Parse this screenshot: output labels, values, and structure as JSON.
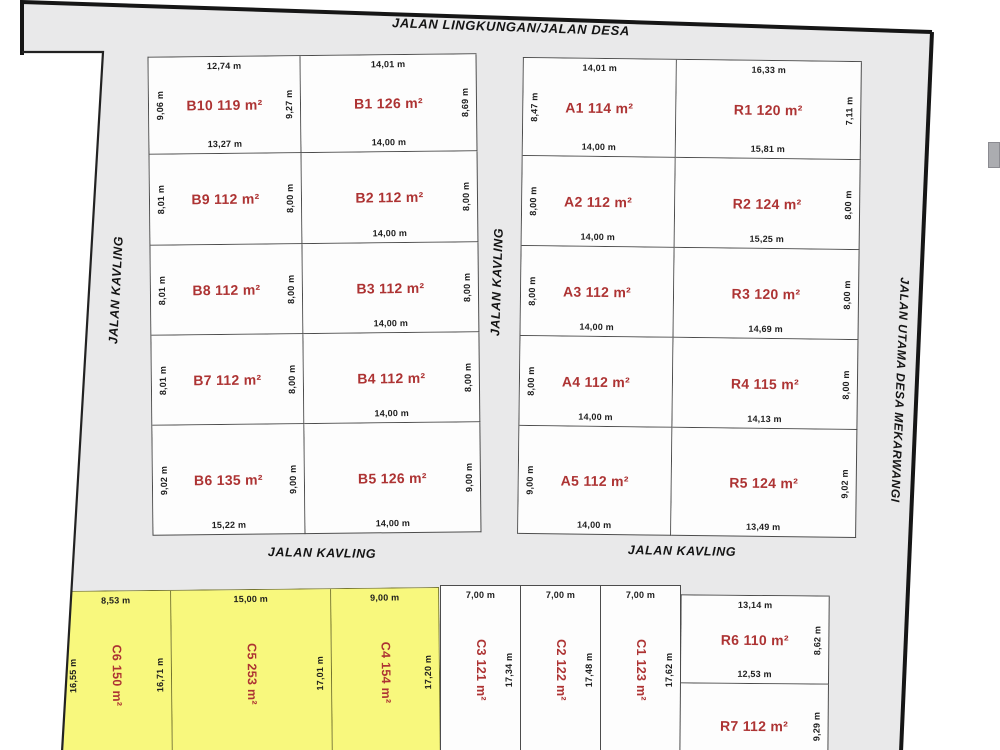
{
  "roads": {
    "top": "JALAN LINGKUNGAN/JALAN DESA",
    "left": "JALAN KAVLING",
    "middle": "JALAN KAVLING",
    "right": "JALAN UTAMA DESA MEKARWANGI",
    "bottom_left": "JALAN KAVLING",
    "bottom_right": "JALAN KAVLING"
  },
  "colors": {
    "road_fill": "#e9e9ea",
    "plot_fill": "#fdfdfd",
    "highlight_fill": "#f8f87d",
    "area_text": "#ad3333",
    "dim_text": "#1d1d1d",
    "boundary": "#161616"
  },
  "blocks": {
    "b_left": [
      {
        "id": "B10",
        "area": "B10 119 m²",
        "top": "12,74 m",
        "left": "9,06 m",
        "right": "9,27 m",
        "bottom": "13,27 m"
      },
      {
        "id": "B9",
        "area": "B9 112 m²",
        "left": "8,01 m",
        "right": "8,00 m"
      },
      {
        "id": "B8",
        "area": "B8 112 m²",
        "left": "8,01 m",
        "right": "8,00 m"
      },
      {
        "id": "B7",
        "area": "B7 112 m²",
        "left": "8,01 m",
        "right": "8,00 m"
      },
      {
        "id": "B6",
        "area": "B6 135 m²",
        "left": "9,02 m",
        "right": "9,00 m",
        "bottom": "15,22 m"
      }
    ],
    "b_right": [
      {
        "id": "B1",
        "area": "B1 126 m²",
        "top": "14,01 m",
        "right": "8,69 m",
        "bottom": "14,00 m"
      },
      {
        "id": "B2",
        "area": "B2 112 m²",
        "right": "8,00 m",
        "bottom": "14,00 m"
      },
      {
        "id": "B3",
        "area": "B3 112 m²",
        "right": "8,00 m",
        "bottom": "14,00 m"
      },
      {
        "id": "B4",
        "area": "B4 112 m²",
        "right": "8,00 m",
        "bottom": "14,00 m"
      },
      {
        "id": "B5",
        "area": "B5 126 m²",
        "right": "9,00 m",
        "bottom": "14,00 m"
      }
    ],
    "a": [
      {
        "id": "A1",
        "area": "A1 114 m²",
        "top": "14,01 m",
        "left": "8,47 m",
        "bottom": "14,00 m"
      },
      {
        "id": "A2",
        "area": "A2 112 m²",
        "left": "8,00 m",
        "bottom": "14,00 m"
      },
      {
        "id": "A3",
        "area": "A3 112 m²",
        "left": "8,00 m",
        "bottom": "14,00 m"
      },
      {
        "id": "A4",
        "area": "A4 112 m²",
        "left": "8,00 m",
        "bottom": "14,00 m"
      },
      {
        "id": "A5",
        "area": "A5 112 m²",
        "left": "9,00 m",
        "bottom": "14,00 m"
      }
    ],
    "r": [
      {
        "id": "R1",
        "area": "R1 120 m²",
        "top": "16,33 m",
        "right": "7,11 m",
        "bottom": "15,81 m"
      },
      {
        "id": "R2",
        "area": "R2 124 m²",
        "right": "8,00 m",
        "bottom": "15,25 m"
      },
      {
        "id": "R3",
        "area": "R3 120 m²",
        "right": "8,00 m",
        "bottom": "14,69 m"
      },
      {
        "id": "R4",
        "area": "R4 115 m²",
        "right": "8,00 m",
        "bottom": "14,13 m"
      },
      {
        "id": "R5",
        "area": "R5 124 m²",
        "right": "9,02 m",
        "bottom": "13,49 m"
      }
    ],
    "c_yellow": [
      {
        "id": "C6",
        "area": "C6 150 m²",
        "top": "8,53 m",
        "left": "16,55 m",
        "right": "16,71 m"
      },
      {
        "id": "C5",
        "area": "C5 253 m²",
        "top": "15,00 m",
        "right": "17,01 m"
      },
      {
        "id": "C4",
        "area": "C4 154 m²",
        "top": "9,00 m",
        "right": "17,20 m"
      }
    ],
    "c_white": [
      {
        "id": "C3",
        "area": "C3 121 m²",
        "top": "7,00 m",
        "right": "17,34 m"
      },
      {
        "id": "C2",
        "area": "C2 122 m²",
        "top": "7,00 m",
        "right": "17,48 m"
      },
      {
        "id": "C1",
        "area": "C1 123 m²",
        "top": "7,00 m",
        "right": "17,62 m"
      }
    ],
    "r_bottom": [
      {
        "id": "R6",
        "area": "R6 110 m²",
        "top": "13,14 m",
        "right": "8,62 m",
        "bottom": "12,53 m"
      },
      {
        "id": "R7",
        "area": "R7 112 m²",
        "right": "9,29 m"
      }
    ]
  }
}
